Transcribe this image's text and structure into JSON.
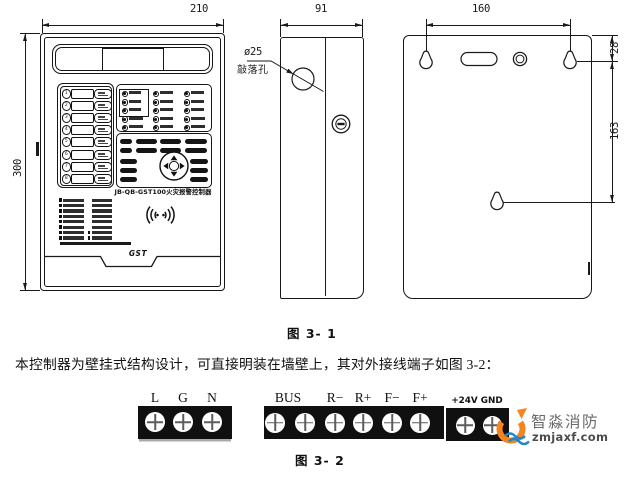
{
  "page": {
    "figure1_caption": "图 3- 1",
    "body_text": "本控制器为壁挂式结构设计，可直接明装在墙壁上，其对外接线端子如图 3-2：",
    "figure2_caption": "图 3- 2"
  },
  "front_view": {
    "width_dim": "210",
    "height_dim": "300",
    "model_label": "JB-QB-GST100火灾报警控制器",
    "brand": "GST",
    "zone_numbers": [
      "1",
      "2",
      "3",
      "4",
      "5",
      "6",
      "7",
      "8"
    ]
  },
  "side_view": {
    "width_dim": "91",
    "knockout_dia": "ø25",
    "knockout_name": "敲落孔"
  },
  "back_view": {
    "hole_span_dim": "160",
    "top_offset_dim": "28",
    "mid_spacing_dim": "163"
  },
  "terminals": {
    "block1_labels": [
      "L",
      "G",
      "N"
    ],
    "block2_labels": [
      "BUS",
      "R−",
      "R+",
      "F−",
      "F+"
    ],
    "block3_label": "+24V GND"
  },
  "watermark": {
    "brand": "智淼消防",
    "site": "zmjaxf.com",
    "orange": "#f5831f",
    "blue": "#2187c6"
  },
  "colors": {
    "ink": "#1a1a1a",
    "terminal_block": "#101010"
  }
}
